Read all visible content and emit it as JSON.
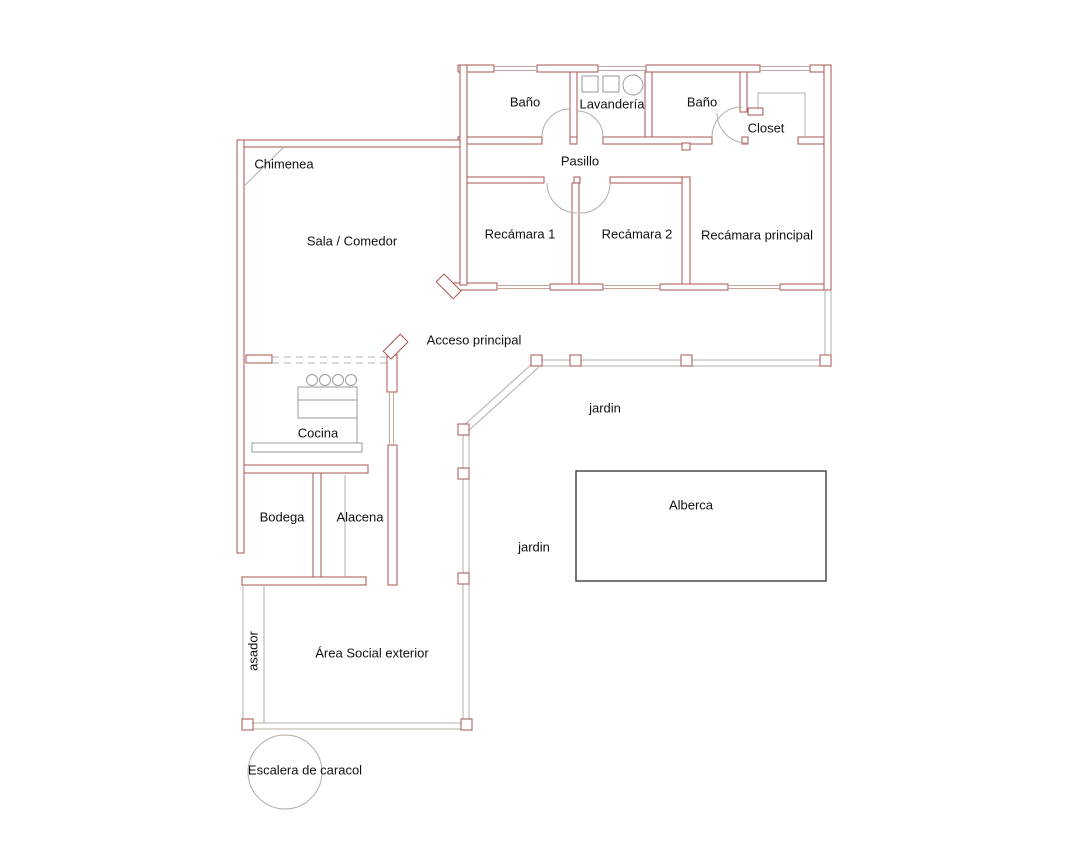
{
  "title": "Floor plan",
  "labels": {
    "chimenea": "Chimenea",
    "bano1": "Baño",
    "lavanderia": "Lavandería",
    "bano2": "Baño",
    "closet": "Closet",
    "pasillo": "Pasillo",
    "sala": "Sala / Comedor",
    "recamara1": "Recámara 1",
    "recamara2": "Recámara 2",
    "recamara_principal": "Recámara principal",
    "acceso": "Acceso principal",
    "cocina": "Cocina",
    "jardin_top": "jardin",
    "jardin_left": "jardin",
    "alberca": "Alberca",
    "bodega": "Bodega",
    "alacena": "Alacena",
    "asador": "asador",
    "area_social": "Área Social exterior",
    "escalera": "Escalera de caracol"
  },
  "icons": {
    "stove": "stove-icon",
    "washer": "washer-icon",
    "laundry_sinks": "laundry-sink-icon",
    "spiral_stairs": "spiral-stairs-icon",
    "fireplace": "fireplace-icon"
  },
  "colors": {
    "wall": "#a85552",
    "detail": "#b5aca4",
    "window": "#c4a49e",
    "counter": "#9a9a9a",
    "pool": "#4a4a4a",
    "text": "#111111",
    "background": "#ffffff"
  }
}
